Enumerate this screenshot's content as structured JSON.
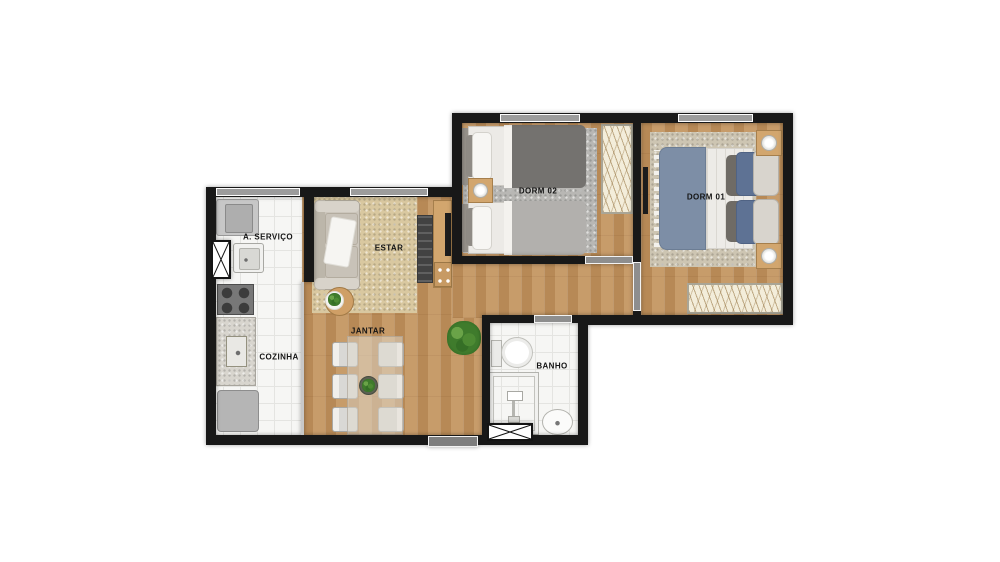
{
  "rooms": {
    "servico": {
      "label": "A. SERVIÇO"
    },
    "cozinha": {
      "label": "COZINHA"
    },
    "estar": {
      "label": "ESTAR"
    },
    "jantar": {
      "label": "JANTAR"
    },
    "dorm02": {
      "label": "DORM 02"
    },
    "dorm01": {
      "label": "DORM 01"
    },
    "banho": {
      "label": "BANHO"
    }
  },
  "palette": {
    "background": "#ffffff",
    "wall": "#181818",
    "wood_floor": "#c3945f",
    "tile_floor": "#f6f6f4",
    "estar_rug": "#d9c8a0",
    "dorm02_rug": "#b8b7b4",
    "dorm01_rug": "#cdc5b2",
    "door": "#8e8e8e",
    "window": "#9c9c9c",
    "wardrobe": "#f3edda",
    "sofa": "#ccc6bc",
    "dorm01_blanket": "#7d8ea6",
    "dorm02_blanket_dark": "#74726f",
    "dorm02_blanket_light": "#b2b0ad",
    "wood_furniture": "#d2a66e"
  }
}
